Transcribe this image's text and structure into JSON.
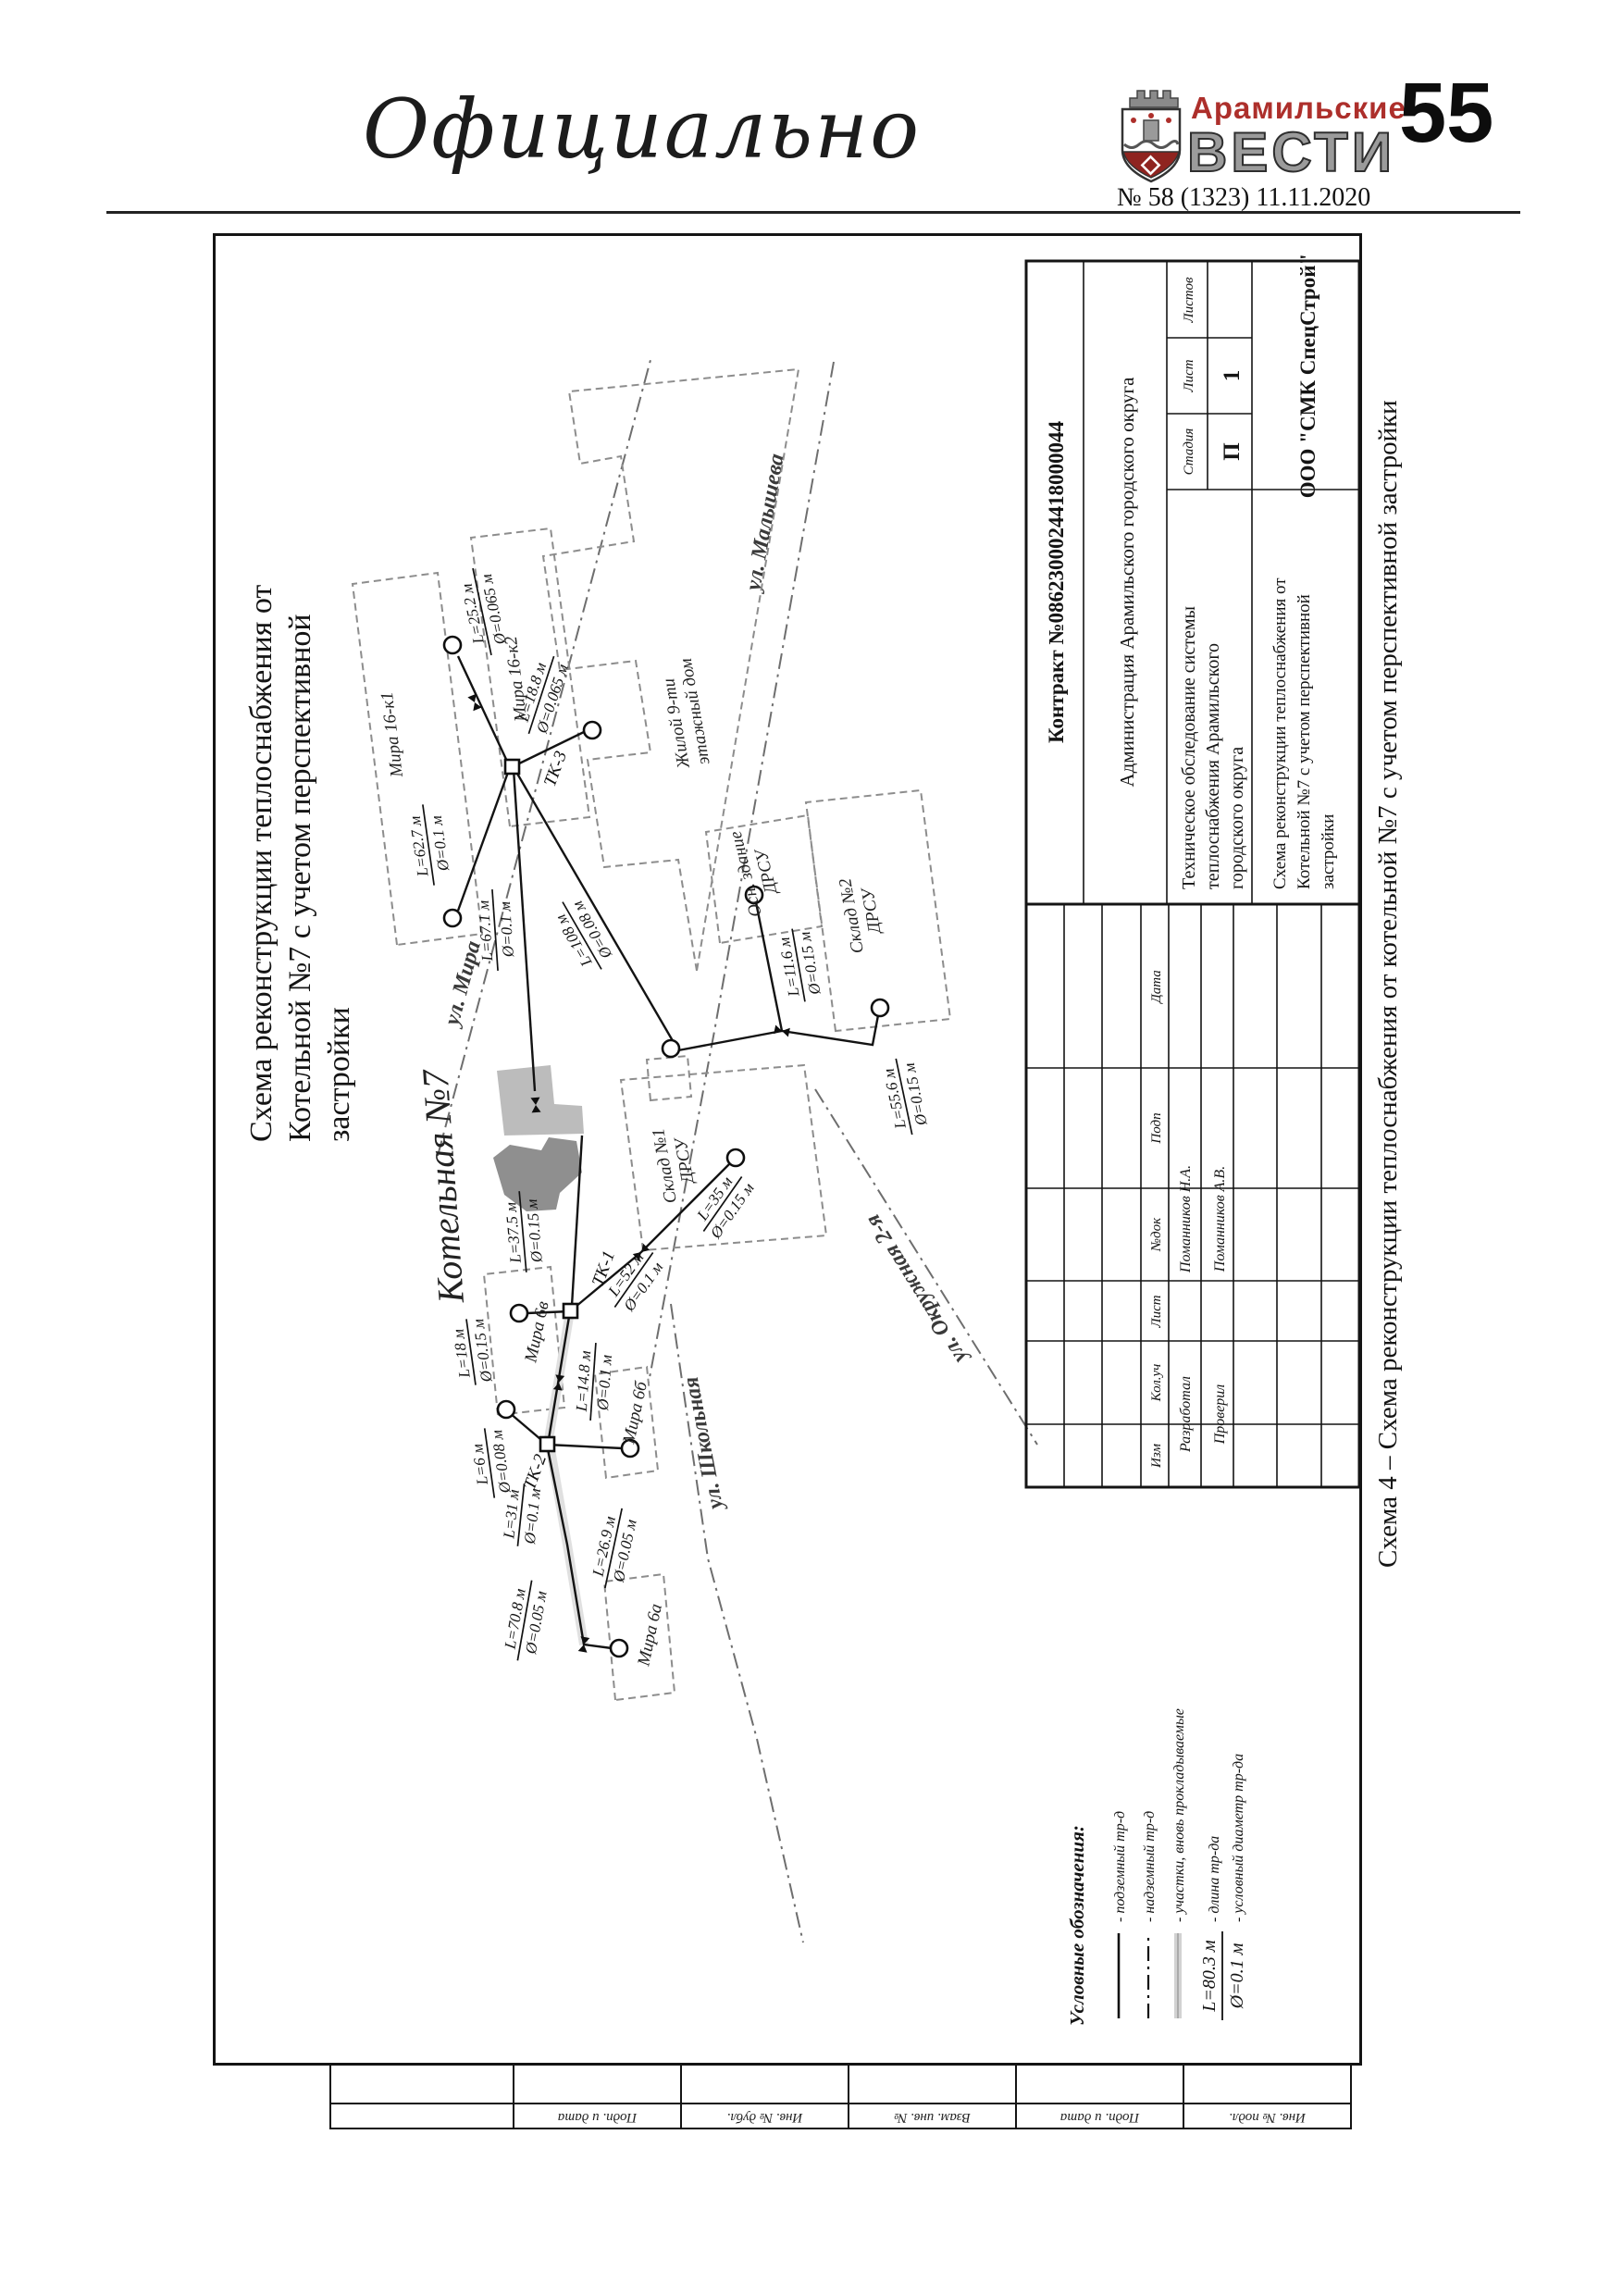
{
  "header": {
    "section_title": "Официально",
    "masthead_top": "Арамильские",
    "masthead_bottom": "ВЕСТИ",
    "issue": "№ 58 (1323) 11.11.2020",
    "page_number": "55",
    "accent_color": "#ad2f2b",
    "gray_color": "#9b9b9b"
  },
  "caption": "Схема 4 – Схема реконструкции теплоснабжения от котельной №7 с учетом перспективной застройки",
  "drawing": {
    "title_lines": [
      "Схема реконструкции теплоснабжения от",
      "Котельной №7 с учетом перспективной",
      "застройки"
    ],
    "streets": {
      "mira": "ул. Мира",
      "malysheva": "ул. Малышева",
      "shkolnaya": "ул. Школьная",
      "okruzhnaya": "ул. Окружная 2-я"
    },
    "buildings": {
      "boiler": "Котельная №7",
      "mira16k1": "Мира 16-к1",
      "mira16k2": "Мира 16-к2",
      "zhiloy_line1": "Жилой 9-ти",
      "zhiloy_line2": "этажный дом",
      "osn_line1": "Осн. здание",
      "osn_line2": "ДРСУ",
      "sklad1_line1": "Склад №1",
      "sklad1_line2": "ДРСУ",
      "sklad2_line1": "Склад №2",
      "sklad2_line2": "ДРСУ",
      "mira6v": "Мира 6в",
      "mira6b": "Мира 6б",
      "mira6a": "Мира 6а"
    },
    "junctions": {
      "tk1": "ТК-1",
      "tk2": "ТК-2",
      "tk3": "ТК-3"
    },
    "pipes": [
      {
        "l": "L=25.2 м",
        "d": "Ø=0.065 м"
      },
      {
        "l": "L=18.8 м",
        "d": "Ø=0.065 м"
      },
      {
        "l": "L=62.7 м",
        "d": "Ø=0.1 м"
      },
      {
        "l": "L=108 м",
        "d": "Ø=0.08 м"
      },
      {
        "l": "L=67.1 м",
        "d": "Ø=0.1 м"
      },
      {
        "l": "L=37.5 м",
        "d": "Ø=0.15 м"
      },
      {
        "l": "L=52 м",
        "d": "Ø=0.1 м"
      },
      {
        "l": "L=35 м",
        "d": "Ø=0.15 м"
      },
      {
        "l": "L=11.6 м",
        "d": "Ø=0.15 м"
      },
      {
        "l": "L=55.6 м",
        "d": "Ø=0.15 м"
      },
      {
        "l": "L=18 м",
        "d": "Ø=0.15 м"
      },
      {
        "l": "L=14.8 м",
        "d": "Ø=0.1 м"
      },
      {
        "l": "L=6 м",
        "d": "Ø=0.08 м"
      },
      {
        "l": "L=31 м",
        "d": "Ø=0.1 м"
      },
      {
        "l": "L=26.9 м",
        "d": "Ø=0.05 м"
      },
      {
        "l": "L=70.8 м",
        "d": "Ø=0.05 м"
      }
    ],
    "legend": {
      "title": "Условные обозначения:",
      "underground": "- подземный тр-д",
      "aboveground": "- надземный тр-д",
      "new_sections": "- участки, вновь прокладываемые",
      "len_sample": "L=80.3 м",
      "len_label": "- длина тр-да",
      "dia_sample": "Ø=0.1 м",
      "dia_label": "- условный диаметр тр-да"
    },
    "stamp": {
      "contract": "Контракт №0862300024418000044",
      "customer": "Администрация Арамильского городского округа",
      "doc_lines": [
        "Техническое обследование системы",
        "теплоснабжения Арамильского",
        "городского округа"
      ],
      "sheet_lines": [
        "Схема реконструкции теплоснабжения от",
        "Котельной №7 с учетом перспективной",
        "застройки"
      ],
      "stage_label": "Стадия",
      "stage_value": "П",
      "sheet_label": "Лист",
      "sheet_value": "1",
      "sheets_label": "Листов",
      "company": "ООО \"СМК СпецСтрой\"",
      "header_cells": [
        "Изм",
        "Кол.уч",
        "Лист",
        "№док",
        "Подп",
        "Дата"
      ],
      "rows": [
        {
          "role": "Разработал",
          "name": "Поманников Н.А."
        },
        {
          "role": "Проверил",
          "name": "Поманников А.В."
        }
      ]
    },
    "side_strip": [
      "Подп. и дата",
      "Инв. № дубл.",
      "Взам. инв. №",
      "Подп. и дата",
      "Инв. № подл."
    ]
  }
}
